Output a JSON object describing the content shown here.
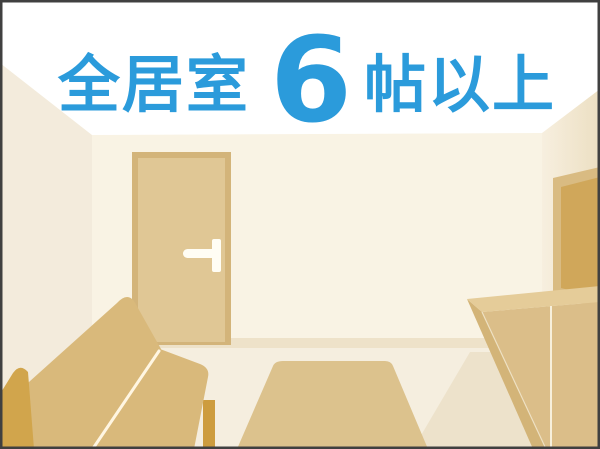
{
  "title": {
    "prefix": "全居室",
    "number": "6",
    "suffix": "帖以上",
    "full_text": "全居室 6 帖以上"
  },
  "scene": {
    "type": "flat-vector room interior illustration",
    "objects": [
      "door",
      "door-handle",
      "sofa",
      "rug",
      "tv-board",
      "wall-art",
      "baseboard"
    ]
  },
  "palette": {
    "accent": "#2b9bdb",
    "ceiling": "#ffffff",
    "wallLeft": "#f3ebdc",
    "wallBack": "#f9f3e4",
    "wallRightNear": "#f7efdf",
    "wallRightFar": "#ecdfc2",
    "baseboard": "#eee2c9",
    "floor": "#f5eedf",
    "floorShadow": "#ede2cb",
    "doorFrame": "#d3b47a",
    "doorFace": "#e0c795",
    "handle": "#fffdf4",
    "artFrame": "#d9bb82",
    "artInner": "#d0a75a",
    "cabinetTop": "#e5cc99",
    "cabinetFront": "#dbbe89",
    "cabinetSide": "#d3b478",
    "cabinetSeam": "#f7f0dc",
    "rug": "#dcc28d",
    "sofa": "#d9b97b",
    "sofaArm": "#d1a54c",
    "sofaLeg": "#cd9c3e",
    "sofaSeam": "#fff6e2",
    "border": "#404040"
  }
}
